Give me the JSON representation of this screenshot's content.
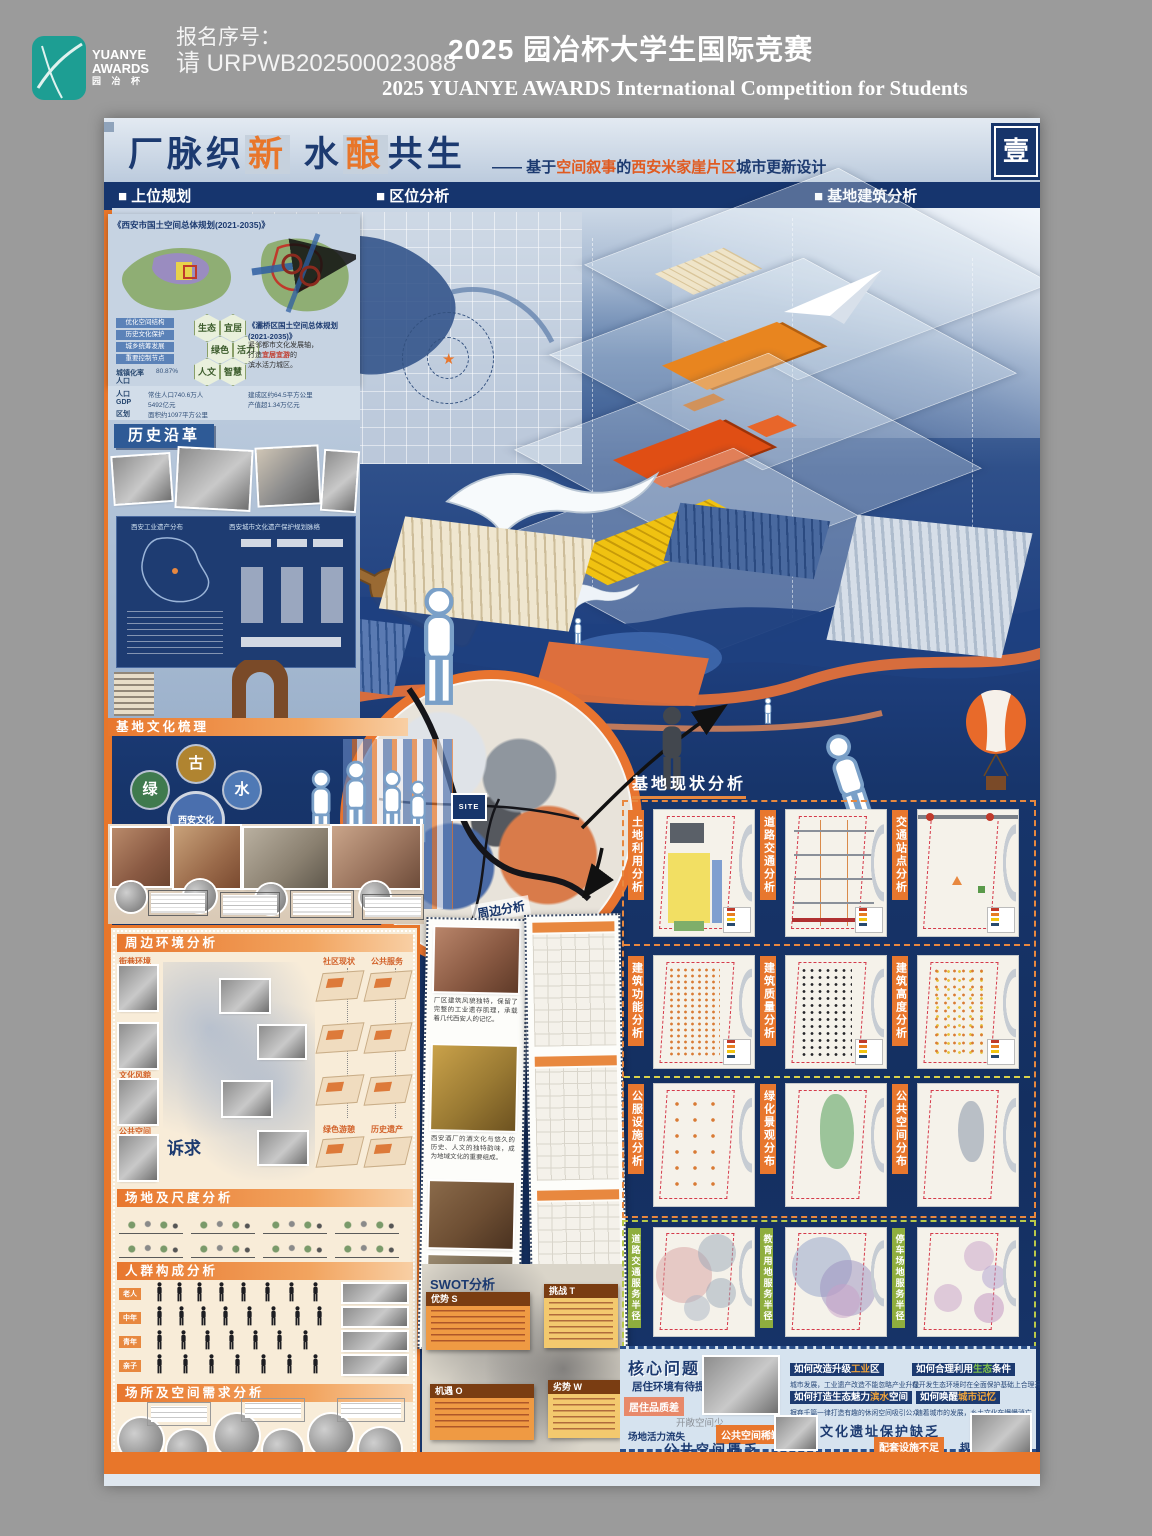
{
  "colors": {
    "accent_orange": "#e8762a",
    "navy": "#17356b",
    "teal": "#1d9e93",
    "cream": "#f8ecd8"
  },
  "header": {
    "logo_line1": "YUANYE",
    "logo_line2": "AWARDS",
    "logo_line3": "园  冶  杯",
    "reg_label": "报名序号：",
    "reg_value": "请 URPWB202500023088",
    "title_cn": "2025 园冶杯大学生国际竞赛",
    "title_en": "2025 YUANYE AWARDS International Competition for  Students"
  },
  "banner": {
    "t1": "厂脉织",
    "t2": "新",
    "t3": "水",
    "t4": "酿",
    "t5": "共生",
    "dash": "——",
    "s1": "基于",
    "s2": "空间叙事",
    "s3": "的",
    "s4": "西安米家崖片区",
    "s5": "城市更新设计",
    "page_badge": "壹"
  },
  "nav": {
    "s1": "■ 上位规划",
    "s2": "■ 区位分析",
    "s3": "■  基地建筑分析",
    "sub1": "■ 西安市总规",
    "sub2": "■ 灞桥区总规"
  },
  "planning": {
    "xian_doc": "《西安市国土空间总体规划(2021-2035)》",
    "baqiao_doc": "《灞桥区国土空间总体规划(2021-2035)》",
    "bq_n1": "紧邻都市文化发展轴，",
    "bq_n2a": "打造",
    "bq_n2b": "宜居宜游",
    "bq_n2c": "的",
    "bq_n3": "滨水活力城区。",
    "chips": [
      "优化空间结构",
      "历史文化保护",
      "城乡统筹发展",
      "重要控制节点"
    ],
    "hexagons": [
      "生态",
      "宜居",
      "绿色",
      "活力",
      "人文",
      "智慧"
    ],
    "stats": [
      {
        "label": "城镇化率",
        "value": "80.87%"
      },
      {
        "label": "人口",
        "value": "常住人口740.6万人"
      },
      {
        "label": "GDP",
        "value": "5492亿元"
      }
    ],
    "stats2": [
      {
        "label": "区划",
        "value": "面积约1097平方公里"
      },
      {
        "label": "",
        "value": "建成区约64.5平方公里"
      },
      {
        "label": "",
        "value": "产值超1.34万亿元"
      }
    ]
  },
  "history": {
    "title": "历史沿革",
    "chart1": "西安工业遗产分布",
    "chart2": "西安城市文化遗产保护规划脉络"
  },
  "culture": {
    "title": "基地文化梳理",
    "wheel_center": "西安文化",
    "petals": [
      "古",
      "水",
      "艺",
      "俗",
      "文",
      "绿"
    ]
  },
  "env": {
    "title": "周边环境分析",
    "photo_tags": [
      "街巷环境",
      "文化风貌",
      "公共空间"
    ],
    "right_tags": [
      "社区现状",
      "公共服务",
      "绿色游憩",
      "历史遗产"
    ],
    "demand": "诉求"
  },
  "scale": {
    "title": "场地及尺度分析"
  },
  "people": {
    "title": "人群构成分析",
    "groups": [
      "老人",
      "中年",
      "青年",
      "亲子"
    ]
  },
  "needs": {
    "title": "场所及空间需求分析"
  },
  "surround": {
    "title": "周边分析",
    "cap1": "厂区建筑风貌独特，保留了完整的工业遗存肌理，承载着几代西安人的记忆。",
    "cap2": "西安酒厂的酒文化与悠久的历史、人文的独特韵味，成为地域文化的重要组成。"
  },
  "swot": {
    "title": "SWOT分析",
    "s": "优势 S",
    "t": "挑战 T",
    "o": "机遇 O",
    "w": "劣势 W"
  },
  "status": {
    "title": "基地现状分析",
    "rows": [
      [
        "土地利用分析",
        "道路交通分析",
        "交通站点分析"
      ],
      [
        "建筑功能分析",
        "建筑质量分析",
        "建筑高度分析"
      ],
      [
        "公服设施分析",
        "绿化景观分布",
        "公共空间分布"
      ],
      [
        "道路交通服务半径",
        "教育用地服务半径",
        "停车场地服务半径"
      ]
    ]
  },
  "problems": {
    "title": "核心问题",
    "p1": "居住环境有待提升",
    "p2": "居住品质差",
    "p3": "开敞空间少",
    "p4": "场地活力流失",
    "p5": "公共空间稀缺",
    "p6": "公共空间匮乏",
    "q1a": "如何改造升级",
    "q1b": "工业",
    "q1c": "区",
    "q1n": "城市发展，工业遗产改造不能忽略产业升级",
    "q2a": "如何合理利用",
    "q2b": "生态",
    "q2c": "条件",
    "q2n": "在开发生态环境时在全面保护基础上合理开发",
    "q3a": "如何打造生态魅力",
    "q3b": "滨水",
    "q3c": "空间",
    "q3n": "摒弃千篇一律打造有趣的休闲空间吸引公众",
    "q4a": "如何唤醒",
    "q4b": "城市记忆",
    "q4n": "随着城市的发展，乡土文化在慢慢消亡",
    "p7": "文化遗址保护缺乏",
    "p8": "配套设施不足",
    "p9": "规划结构混乱"
  },
  "site_label": "SITE"
}
